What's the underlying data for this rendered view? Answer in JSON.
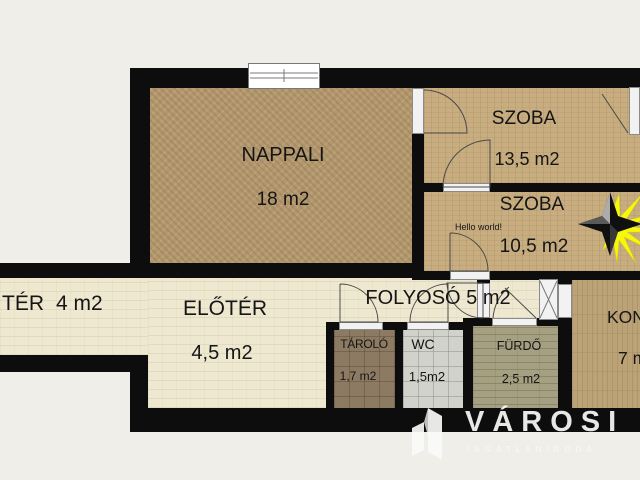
{
  "colors": {
    "background": "#efeee9",
    "wall": "#0d0d0d",
    "floor_carpet": "#b3986e",
    "floor_wood": "#c7ad80",
    "floor_kitchen": "#bca377",
    "floor_cream": "#efe8d0",
    "floor_tile_brown": "#8d7a63",
    "floor_tile_gray": "#d2d2cd",
    "floor_tile_olive": "#a6a083",
    "star_yellow": "#f7f70a",
    "watermark": "#faFAf7"
  },
  "rooms": {
    "nappali": {
      "name": "NAPPALI",
      "area": "18 m2"
    },
    "szoba_top": {
      "name": "SZOBA",
      "area": "13,5 m2"
    },
    "szoba_mid": {
      "name": "SZOBA",
      "area": "10,5 m2",
      "note": "Hello world!"
    },
    "balcony": {
      "name": "TÉR",
      "area": "4 m2"
    },
    "eloter": {
      "name": "ELŐTÉR",
      "area": "4,5 m2"
    },
    "folyoso": {
      "label": "FOLYOSÓ 5 m2"
    },
    "tarolo": {
      "name": "TÁROLÓ",
      "area": "1,7 m2"
    },
    "wc": {
      "name": "WC",
      "area": "1,5m2"
    },
    "furdo": {
      "name": "FÜRDŐ",
      "area": "2,5 m2"
    },
    "konyha": {
      "name": "KON",
      "area": "7 m"
    }
  },
  "watermark": {
    "brand": "VÁROSI",
    "subtitle": "INGATLANIRODA"
  }
}
